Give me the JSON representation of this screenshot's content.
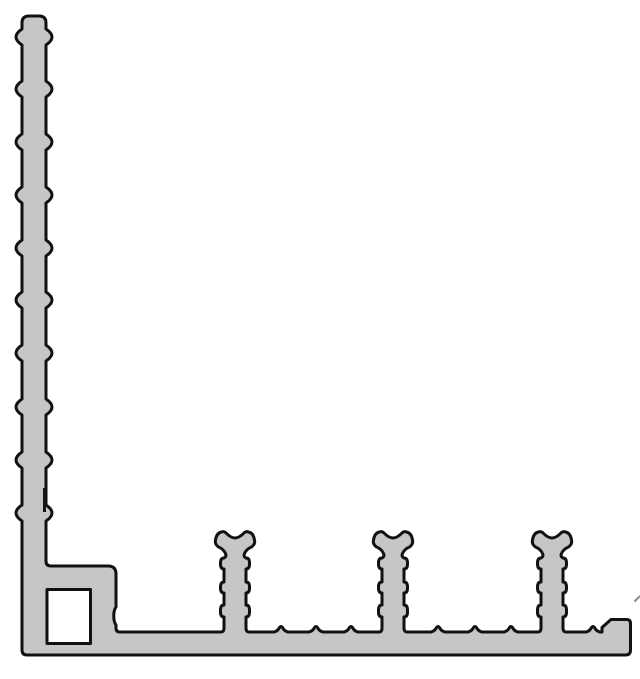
{
  "canvas": {
    "width": 640,
    "height": 679,
    "background": "#ffffff"
  },
  "drawing": {
    "kind": "extrusion-profile-cross-section",
    "fill_color": "#c6c6c6",
    "outline_color": "#111111",
    "outline_width": 3,
    "vertical_leg": {
      "left": 22,
      "right": 46,
      "top": 16,
      "rib_centers": [
        37,
        89,
        142,
        195,
        248,
        300,
        353,
        407,
        460,
        513
      ],
      "rib_depth": 6,
      "rib_half": 8
    },
    "corner_block": {
      "top": 566,
      "right": 116,
      "notch_top": 607,
      "notch_bottom": 625,
      "notch_depth": 3
    },
    "base": {
      "top": 632,
      "bottom": 655,
      "teeth_centers": [
        281,
        316,
        351,
        438,
        475,
        511,
        593
      ],
      "tooth": {
        "half_width": 7,
        "height": 6.5
      }
    },
    "studs": {
      "centers": [
        235,
        393,
        552
      ],
      "geometry": {
        "stem": 11,
        "barb": 14.5,
        "neck": 9,
        "head": 20.5,
        "horn": 11,
        "head_top": 531,
        "dip_y": 538,
        "bulge_y": 541,
        "neck_y": 556,
        "barbs": [
          [
            558,
            569
          ],
          [
            582,
            593
          ],
          [
            605,
            617
          ]
        ],
        "fillet": 14
      }
    },
    "end_hook": {
      "notch_x": 602,
      "notch_y": 627.5,
      "lip_left": 611,
      "lip_top": 619.5,
      "right": 630.5
    },
    "hole": {
      "x": 47,
      "y": 589.5,
      "w": 43.5,
      "h": 54
    },
    "artifacts": {
      "edge_line": {
        "x": 44.5,
        "y1": 488,
        "y2": 512,
        "color": "#151515",
        "width": 3
      },
      "tick": {
        "x1": 635,
        "y1": 601,
        "x2": 639.5,
        "y2": 596.5,
        "color": "#8a8a8a",
        "width": 2
      }
    }
  }
}
